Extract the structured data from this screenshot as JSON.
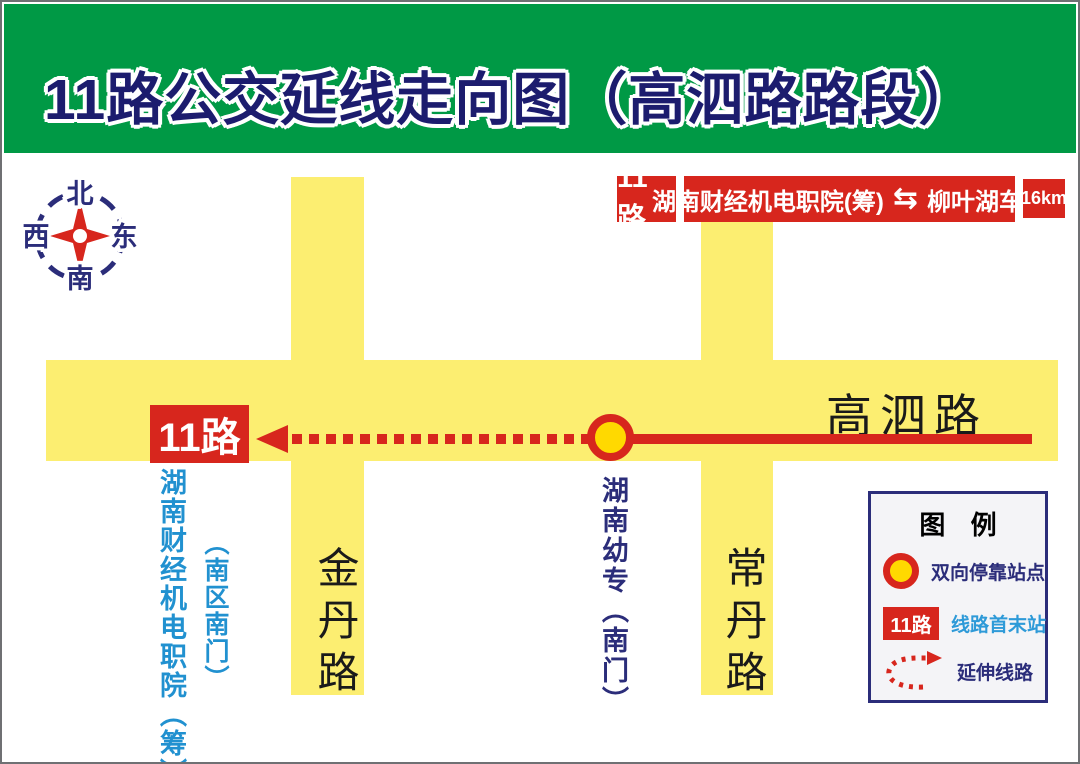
{
  "header": {
    "title": "11路公交延线走向图（高泗路路段）"
  },
  "compass": {
    "north": "北",
    "south": "南",
    "west": "西",
    "east": "东"
  },
  "route_bar": {
    "route_badge": "11路",
    "terminal_a": "湖南财经机电职院(筹)",
    "arrow_glyph": "⇆",
    "terminal_b": "柳叶湖车站",
    "distance": "16km"
  },
  "map": {
    "roads": {
      "horizontal_label": "高泗路",
      "vertical_left_label": "金丹路",
      "vertical_right_label": "常丹路"
    },
    "route": {
      "badge": "11路",
      "terminal_name": "湖南财经机电职院（筹）",
      "terminal_sub": "（南区南门）",
      "station_name": "湖南幼专（南门）"
    }
  },
  "legend": {
    "title": "图 例",
    "items": [
      {
        "symbol": "station-circle",
        "label": "双向停靠站点"
      },
      {
        "symbol": "route-badge",
        "badge_text": "11路",
        "label": "线路首末站"
      },
      {
        "symbol": "dotted-arrow",
        "label": "延伸线路"
      }
    ]
  },
  "colors": {
    "header_green": "#009945",
    "route_red": "#d7261d",
    "road_yellow": "#fcee71",
    "station_yellow": "#ffd900",
    "navy": "#2b2d7a",
    "title_navy": "#1c1c6e",
    "light_blue": "#2191d0"
  }
}
